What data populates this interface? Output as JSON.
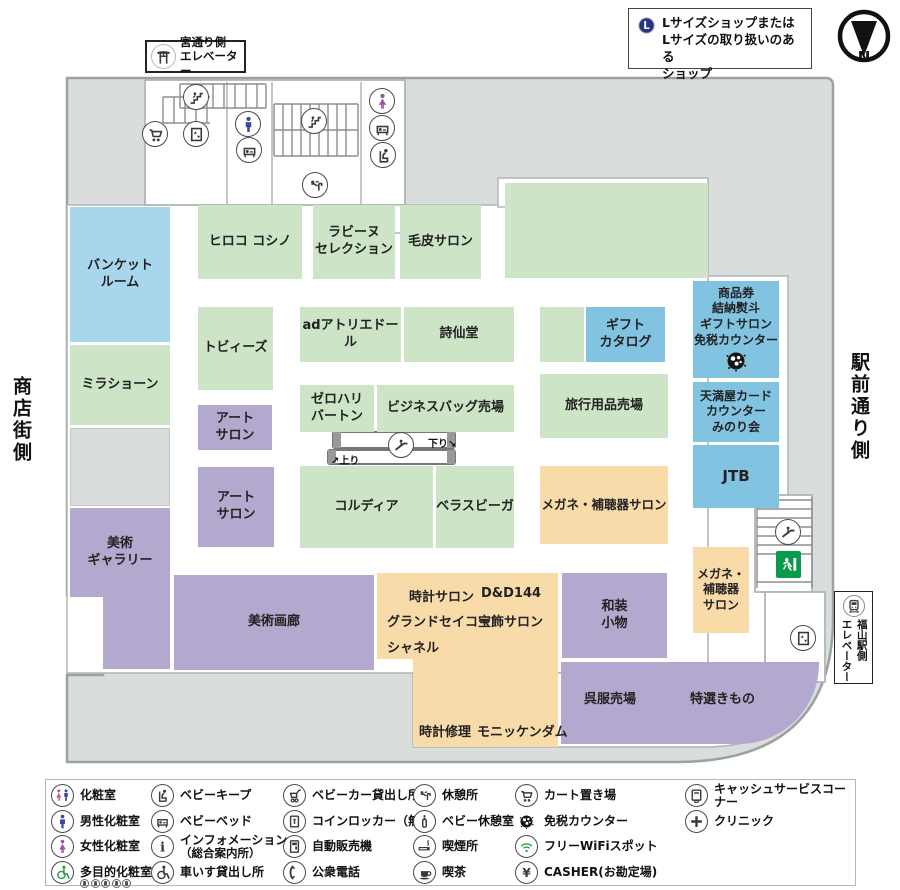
{
  "header": {
    "lsize_note": "Lサイズショップまたは\nLサイズの取り扱いのある\nショップ",
    "compass_label": "N",
    "miya_elevator_sign": "宮通り側\nエレベーター"
  },
  "side_labels": {
    "left": "商店街側",
    "right": "駅前通り側"
  },
  "fukuyama_elevator_sign": {
    "line1": "福山駅側",
    "line2": "エレベーター"
  },
  "escalator": {
    "down_label": "下り↘",
    "up_label": "↗上り"
  },
  "colors": {
    "shop_green": "#cde4c6",
    "facility_blue": "#82c3e2",
    "banquet_blue": "#a9d6ec",
    "salon_purple": "#b3a9ce",
    "service_orange": "#f9dba9",
    "corridor_gray": "#d9dedd"
  },
  "map": {
    "rooms": [
      {
        "id": "banquet-room",
        "label": "バンケット\nルーム",
        "type": "blue",
        "x": 70,
        "y": 207,
        "w": 100,
        "h": 135
      },
      {
        "id": "mila-schon",
        "label": "ミラショーン",
        "type": "green",
        "x": 70,
        "y": 345,
        "w": 100,
        "h": 80
      },
      {
        "id": "back-area",
        "label": "",
        "type": "grayb",
        "x": 70,
        "y": 428,
        "w": 100,
        "h": 78
      },
      {
        "id": "art-gallery",
        "label": "美術\nギャラリー",
        "type": "purple",
        "x": 70,
        "y": 508,
        "w": 100,
        "h": 89
      },
      {
        "id": "art-gallery-ext",
        "label": "",
        "type": "purple",
        "x": 103,
        "y": 597,
        "w": 67,
        "h": 72
      },
      {
        "id": "hiroko-koshino",
        "label": "ヒロコ コシノ",
        "type": "green",
        "x": 198,
        "y": 205,
        "w": 104,
        "h": 74
      },
      {
        "id": "lapine-selection",
        "label": "ラビーヌ\nセレクション",
        "type": "green",
        "x": 313,
        "y": 205,
        "w": 82,
        "h": 74
      },
      {
        "id": "fur-salon",
        "label": "毛皮サロン",
        "type": "green",
        "x": 400,
        "y": 205,
        "w": 81,
        "h": 74
      },
      {
        "id": "sales-area-green",
        "label": "",
        "type": "green",
        "x": 505,
        "y": 183,
        "w": 203,
        "h": 95
      },
      {
        "id": "tobys",
        "label": "トビィーズ",
        "type": "green",
        "x": 198,
        "y": 307,
        "w": 75,
        "h": 83
      },
      {
        "id": "ad-atelier-dor",
        "label": "adアトリエドール",
        "type": "green",
        "x": 300,
        "y": 307,
        "w": 101,
        "h": 55
      },
      {
        "id": "shisendo",
        "label": "詩仙堂",
        "type": "green",
        "x": 404,
        "y": 307,
        "w": 110,
        "h": 55
      },
      {
        "id": "small-green",
        "label": "",
        "type": "green",
        "x": 540,
        "y": 307,
        "w": 44,
        "h": 55
      },
      {
        "id": "gift-catalog",
        "label": "ギフト\nカタログ",
        "type": "blue2",
        "x": 586,
        "y": 307,
        "w": 79,
        "h": 55
      },
      {
        "id": "gift-salon-duty-free",
        "label": "商品券\n結納熨斗\nギフトサロン\n免税カウンター",
        "type": "blue2",
        "x": 693,
        "y": 281,
        "w": 86,
        "h": 97,
        "fs": 12,
        "icon": "duty-free"
      },
      {
        "id": "art-salon-1",
        "label": "アート\nサロン",
        "type": "purple",
        "x": 198,
        "y": 405,
        "w": 74,
        "h": 45
      },
      {
        "id": "zero-halliburton",
        "label": "ゼロハリ\nバートン",
        "type": "green",
        "x": 300,
        "y": 385,
        "w": 74,
        "h": 47
      },
      {
        "id": "business-bag",
        "label": "ビジネスバッグ売場",
        "type": "green",
        "x": 377,
        "y": 385,
        "w": 137,
        "h": 47
      },
      {
        "id": "travel-goods",
        "label": "旅行用品売場",
        "type": "green",
        "x": 540,
        "y": 374,
        "w": 128,
        "h": 64
      },
      {
        "id": "tenmaya-card",
        "label": "天満屋カード\nカウンター\nみのり会",
        "type": "blue2",
        "x": 693,
        "y": 382,
        "w": 86,
        "h": 60,
        "fs": 12
      },
      {
        "id": "jtb",
        "label": "JTB",
        "type": "blue2",
        "x": 693,
        "y": 445,
        "w": 86,
        "h": 63,
        "fs": 15
      },
      {
        "id": "art-salon-2",
        "label": "アート\nサロン",
        "type": "purple",
        "x": 198,
        "y": 467,
        "w": 76,
        "h": 80
      },
      {
        "id": "cordia",
        "label": "コルディア",
        "type": "green",
        "x": 300,
        "y": 466,
        "w": 133,
        "h": 82
      },
      {
        "id": "bella-spiga",
        "label": "ベラスビーガ",
        "type": "green",
        "x": 436,
        "y": 466,
        "w": 78,
        "h": 82
      },
      {
        "id": "megane-hochoki-salon",
        "label": "メガネ・補聴器サロン",
        "type": "orange",
        "x": 540,
        "y": 466,
        "w": 128,
        "h": 78,
        "fs": 12.5
      },
      {
        "id": "megane-hochoki-salon-2",
        "label": "メガネ・\n補聴器\nサロン",
        "type": "orange",
        "x": 693,
        "y": 547,
        "w": 56,
        "h": 86,
        "fs": 12
      },
      {
        "id": "bijutsu-garo",
        "label": "美術画廊",
        "type": "purple",
        "x": 174,
        "y": 575,
        "w": 200,
        "h": 95
      },
      {
        "id": "watch-block-upper",
        "label": "",
        "type": "orange",
        "x": 377,
        "y": 573,
        "w": 181,
        "h": 86
      },
      {
        "id": "watch-block-lower",
        "label": "",
        "type": "orange",
        "x": 413,
        "y": 658,
        "w": 145,
        "h": 89
      },
      {
        "id": "wasou-komono",
        "label": "和装\n小物",
        "type": "purple",
        "x": 562,
        "y": 573,
        "w": 105,
        "h": 85
      },
      {
        "id": "gofuku-block",
        "label": "",
        "type": "purple round-br",
        "x": 561,
        "y": 662,
        "w": 258,
        "h": 82
      }
    ],
    "floating_labels": [
      {
        "id": "tokei-salon",
        "text": "時計サロン",
        "x": 409,
        "y": 586
      },
      {
        "id": "dd144",
        "text": "D&D144",
        "x": 481,
        "y": 586
      },
      {
        "id": "grand-seiko",
        "text": "グランドセイコー",
        "x": 387,
        "y": 611
      },
      {
        "id": "hoshoku-salon",
        "text": "宝飾サロン",
        "x": 478,
        "y": 611
      },
      {
        "id": "chanel",
        "text": "シャネル",
        "x": 387,
        "y": 637
      },
      {
        "id": "tokei-shuri",
        "text": "時計修理",
        "x": 419,
        "y": 721
      },
      {
        "id": "monnickendam",
        "text": "モニッケンダム",
        "x": 477,
        "y": 721
      },
      {
        "id": "gofuku-uriba",
        "text": "呉服売場",
        "x": 584,
        "y": 688
      },
      {
        "id": "tokusen-kimono",
        "text": "特選きもの",
        "x": 690,
        "y": 688
      }
    ],
    "icons": [
      {
        "type": "cart",
        "x": 155,
        "y": 134
      },
      {
        "type": "stairs",
        "x": 196,
        "y": 97
      },
      {
        "type": "elevator",
        "x": 196,
        "y": 134
      },
      {
        "type": "male",
        "x": 248,
        "y": 124
      },
      {
        "type": "baby-bed",
        "x": 249,
        "y": 150
      },
      {
        "type": "stairs",
        "x": 314,
        "y": 121
      },
      {
        "type": "female",
        "x": 382,
        "y": 101
      },
      {
        "type": "baby-bed",
        "x": 382,
        "y": 128
      },
      {
        "type": "baby-keep",
        "x": 383,
        "y": 155
      },
      {
        "type": "rest-area",
        "x": 315,
        "y": 185
      },
      {
        "type": "escalator",
        "x": 401,
        "y": 445
      },
      {
        "type": "escalator",
        "x": 788,
        "y": 532
      },
      {
        "type": "elevator",
        "x": 803,
        "y": 638
      }
    ]
  },
  "legend": {
    "columns": [
      [
        {
          "icon": "restroom",
          "label": "化粧室"
        },
        {
          "icon": "male",
          "label": "男性化粧室"
        },
        {
          "icon": "female",
          "label": "女性化粧室"
        },
        {
          "icon": "wheelchair-green",
          "label": "多目的化粧室",
          "sub_icons": 5
        }
      ],
      [
        {
          "icon": "baby-keep",
          "label": "ベビーキープ"
        },
        {
          "icon": "baby-bed",
          "label": "ベビーベッド"
        },
        {
          "icon": "info",
          "label": "インフォメーション",
          "label2": "（総合案内所）"
        },
        {
          "icon": "wheelchair",
          "label": "車いす貸出し所"
        }
      ],
      [
        {
          "icon": "stroller",
          "label": "ベビーカー貸出し所"
        },
        {
          "icon": "coin-locker",
          "label": "コインロッカー（無料）"
        },
        {
          "icon": "vending",
          "label": "自動販売機"
        },
        {
          "icon": "phone",
          "label": "公衆電話"
        }
      ],
      [
        {
          "icon": "rest-area",
          "label": "休憩所"
        },
        {
          "icon": "baby-rest",
          "label": "ベビー休憩室"
        },
        {
          "icon": "smoking",
          "label": "喫煙所"
        },
        {
          "icon": "coffee",
          "label": "喫茶"
        }
      ],
      [
        {
          "icon": "cart",
          "label": "カート置き場"
        },
        {
          "icon": "duty-free",
          "label": "免税カウンター"
        },
        {
          "icon": "wifi",
          "label": "フリーWiFiスポット"
        },
        {
          "icon": "yen",
          "label": "CASHER(お勘定場)"
        }
      ],
      [
        {
          "icon": "atm",
          "label": "キャッシュサービスコーナー"
        },
        {
          "icon": "clinic",
          "label": "クリニック"
        }
      ]
    ]
  }
}
